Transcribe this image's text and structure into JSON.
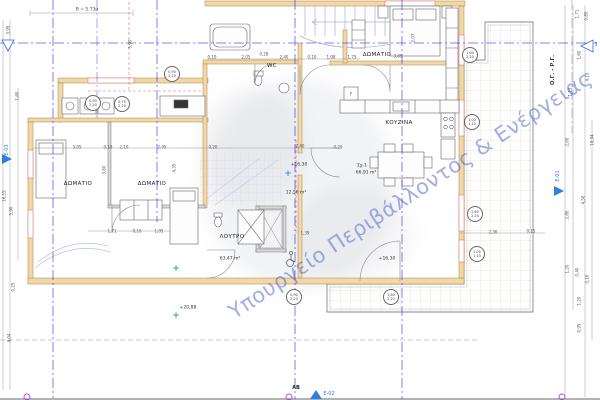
{
  "watermark": {
    "text": "Υπουργείο Περιβάλλοντος & Ενέργειας"
  },
  "annotations": {
    "top_dimension": "Β = 5.73μ",
    "boundary_line_label": "Ο.Γ. - Ρ.Γ.",
    "grid_bubble": "1",
    "datum_label": "ΑΒ"
  },
  "rooms": [
    {
      "label": "ΔΩΜΑΤΙΟ",
      "x": 78,
      "y": 184
    },
    {
      "label": "ΔΩΜΑΤΙΟ",
      "x": 152,
      "y": 184
    },
    {
      "label": "ΔΩΜΑΤΙΟ",
      "x": 377,
      "y": 55
    },
    {
      "label": "ΚΟΥΖΙΝΑ",
      "x": 399,
      "y": 123
    },
    {
      "label": "WC",
      "x": 272,
      "y": 66
    },
    {
      "label": "ΛΟΥΤΡΟ",
      "x": 232,
      "y": 237
    }
  ],
  "areas": [
    {
      "label": "Σχ-1",
      "x": 362,
      "y": 166
    },
    {
      "label": "66,91 m²",
      "x": 366,
      "y": 173
    },
    {
      "label": "12,56 m²",
      "x": 296,
      "y": 193
    },
    {
      "label": "63,47 m²",
      "x": 230,
      "y": 259
    }
  ],
  "levels": [
    {
      "label": "+16,30",
      "x": 299,
      "y": 165
    },
    {
      "label": "+16,30",
      "x": 387,
      "y": 259
    },
    {
      "label": "+20,88",
      "x": 188,
      "y": 308
    }
  ],
  "markers": [
    {
      "label": "E-01"
    },
    {
      "label": "E-02"
    },
    {
      "label": "E-03"
    }
  ],
  "dims": [
    {
      "label": "0,10",
      "x": 212,
      "y": 57
    },
    {
      "label": "2,05",
      "x": 246,
      "y": 57
    },
    {
      "label": "0,28",
      "x": 264,
      "y": 54
    },
    {
      "label": "2,40",
      "x": 284,
      "y": 57
    },
    {
      "label": "0,10",
      "x": 312,
      "y": 57
    },
    {
      "label": "1,08",
      "x": 331,
      "y": 57
    },
    {
      "label": "1,75",
      "x": 352,
      "y": 57
    },
    {
      "label": "3,05",
      "x": 398,
      "y": 56
    },
    {
      "label": "3,05",
      "x": 77,
      "y": 147
    },
    {
      "label": "0,10",
      "x": 108,
      "y": 147
    },
    {
      "label": "2,10",
      "x": 124,
      "y": 147
    },
    {
      "label": "2,95",
      "x": 162,
      "y": 147
    },
    {
      "label": "0,20",
      "x": 213,
      "y": 147
    },
    {
      "label": "2,40",
      "x": 300,
      "y": 146
    },
    {
      "label": "0,20",
      "x": 338,
      "y": 147
    },
    {
      "label": "1,71",
      "x": 112,
      "y": 231
    },
    {
      "label": "0,10",
      "x": 137,
      "y": 231
    },
    {
      "label": "1,05",
      "x": 159,
      "y": 231
    },
    {
      "label": "1,39",
      "x": 305,
      "y": 233
    },
    {
      "label": "2,36",
      "x": 493,
      "y": 232
    },
    {
      "label": "0,15",
      "x": 531,
      "y": 231
    },
    {
      "label": "F",
      "x": 351,
      "y": 94
    },
    {
      "label": "3,95",
      "x": 8,
      "y": 30,
      "rot": -90
    },
    {
      "label": "1,60",
      "x": 17,
      "y": 96,
      "rot": -90
    },
    {
      "label": "16,15",
      "x": 4,
      "y": 196,
      "rot": -90
    },
    {
      "label": "5,90",
      "x": 11,
      "y": 211,
      "rot": -90
    },
    {
      "label": "0,25",
      "x": 13,
      "y": 287,
      "rot": -90
    },
    {
      "label": "4,04",
      "x": 9,
      "y": 338,
      "rot": -90
    },
    {
      "label": "5,90",
      "x": 130,
      "y": 44,
      "rot": -90
    },
    {
      "label": "3,60",
      "x": 104,
      "y": 170,
      "rot": -90
    },
    {
      "label": "4,35",
      "x": 174,
      "y": 168,
      "rot": -90
    },
    {
      "label": "2,07",
      "x": 413,
      "y": 38,
      "rot": -90
    },
    {
      "label": "1,71",
      "x": 577,
      "y": 14,
      "rot": -90
    },
    {
      "label": "0,80",
      "x": 586,
      "y": 16,
      "rot": -90
    },
    {
      "label": "1,60",
      "x": 579,
      "y": 55,
      "rot": -90
    },
    {
      "label": "4,15",
      "x": 587,
      "y": 77,
      "rot": -90
    },
    {
      "label": "1,15",
      "x": 570,
      "y": 92,
      "rot": -90
    },
    {
      "label": "2,60",
      "x": 567,
      "y": 142,
      "rot": -90
    },
    {
      "label": "18,94",
      "x": 592,
      "y": 140,
      "rot": -90
    },
    {
      "label": "4,50",
      "x": 583,
      "y": 200,
      "rot": -90
    },
    {
      "label": "2,80",
      "x": 567,
      "y": 215,
      "rot": -90
    },
    {
      "label": "1,20",
      "x": 567,
      "y": 269,
      "rot": -90
    },
    {
      "label": "0,40",
      "x": 577,
      "y": 272,
      "rot": -90
    },
    {
      "label": "0,10",
      "x": 587,
      "y": 279,
      "rot": -90
    },
    {
      "label": "1,20",
      "x": 579,
      "y": 301,
      "rot": -90
    },
    {
      "label": "0,95",
      "x": 579,
      "y": 328,
      "rot": -90
    }
  ],
  "tags": [
    {
      "top": "0,90",
      "bottom": "2,20",
      "x": 93,
      "y": 103
    },
    {
      "top": "0,75",
      "bottom": "2,20",
      "x": 122,
      "y": 104
    },
    {
      "top": "0,90",
      "bottom": "2,20",
      "x": 172,
      "y": 74
    },
    {
      "top": "1,60",
      "bottom": "2,20",
      "x": 470,
      "y": 55
    },
    {
      "top": "1,00",
      "bottom": "1,10",
      "x": 472,
      "y": 122
    },
    {
      "top": "2,60",
      "bottom": "2,20",
      "x": 475,
      "y": 214
    },
    {
      "top": "1,00",
      "bottom": "1,10",
      "x": 477,
      "y": 254
    },
    {
      "top": "0,90",
      "bottom": "2,20",
      "x": 294,
      "y": 297
    },
    {
      "top": "1,60",
      "bottom": "2,20",
      "x": 391,
      "y": 297
    }
  ],
  "stars": [
    {
      "x": 288,
      "y": 174
    },
    {
      "x": 176,
      "y": 269
    },
    {
      "x": 176,
      "y": 316
    }
  ],
  "survey_points": [
    {
      "x": 27,
      "y": 397
    },
    {
      "x": 289,
      "y": 397
    },
    {
      "x": 562,
      "y": 397
    }
  ],
  "colors": {
    "axis_blue": "#2a2af0",
    "wall_fill": "#f2d7a7",
    "wall_edge": "#a8854e",
    "red_dash": "#e06a6a",
    "stair_blue": "#a8b2d4",
    "watermark_blue": "#485ec8",
    "marker_blue": "#2f7fe0",
    "survey_purple": "#a855d8"
  }
}
